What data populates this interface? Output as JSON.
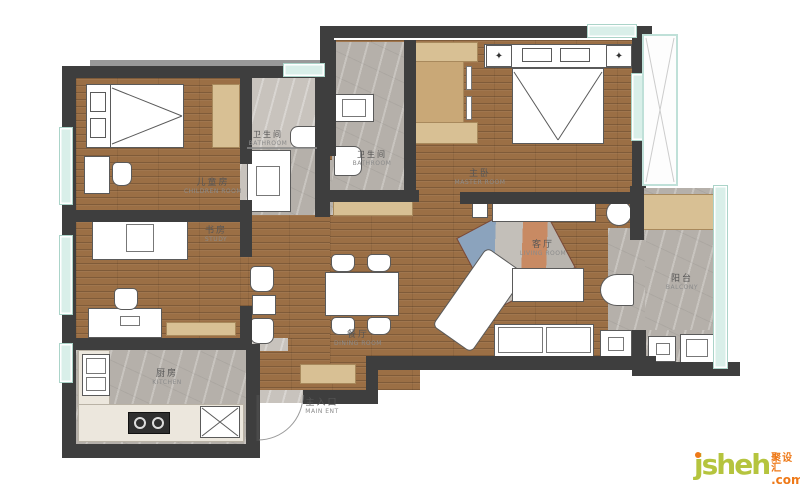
{
  "page": {
    "background": "#ffffff",
    "type": "apartment floor plan"
  },
  "palette": {
    "page_bg": "#ffffff",
    "wall": "#3e3e3e",
    "wood": "#9b6f45",
    "marble": "#b5b0aa",
    "cabinet": "#d8c094",
    "window": "#d9efe9",
    "brand": "#b5c43e",
    "accent": "#ee7918"
  },
  "rooms": [
    {
      "id": "children_room",
      "zh": "儿童房",
      "en": "CHILDREN ROOM"
    },
    {
      "id": "bathroom_1",
      "zh": "卫生间",
      "en": "BATHROOM"
    },
    {
      "id": "bathroom_2",
      "zh": "卫生间",
      "en": "BATHROOM"
    },
    {
      "id": "master_room",
      "zh": "主卧",
      "en": "MASTER ROOM"
    },
    {
      "id": "study",
      "zh": "书房",
      "en": "STUDY"
    },
    {
      "id": "living_room",
      "zh": "客厅",
      "en": "LIVING ROOM"
    },
    {
      "id": "dining_room",
      "zh": "餐厅",
      "en": "DINING ROOM"
    },
    {
      "id": "kitchen",
      "zh": "厨房",
      "en": "KITCHEN"
    },
    {
      "id": "balcony",
      "zh": "阳台",
      "en": "BALCONY"
    },
    {
      "id": "main_entrance",
      "zh": "主入口",
      "en": "MAIN ENT"
    }
  ],
  "logo": {
    "brand": "jsheh",
    "tld": ".com",
    "cn": "聚设汇"
  }
}
